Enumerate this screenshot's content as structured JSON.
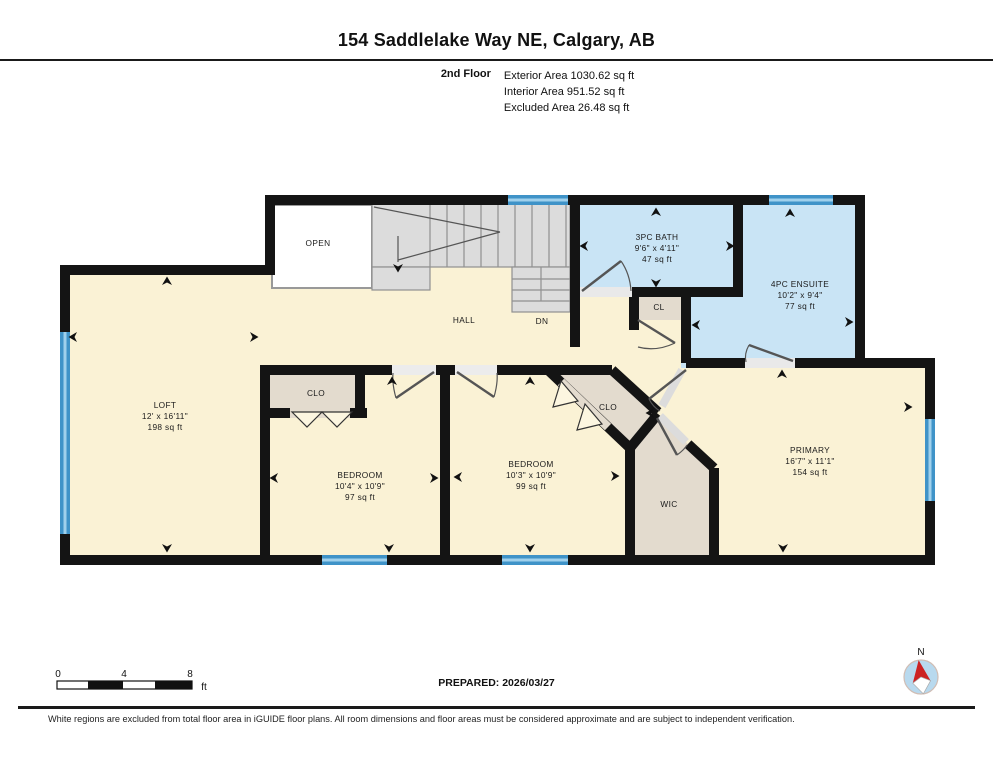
{
  "header": {
    "title": "154 Saddlelake Way NE, Calgary, AB",
    "floor_label": "2nd Floor",
    "areas": [
      "Exterior Area 1030.62 sq ft",
      "Interior Area 951.52 sq ft",
      "Excluded Area 26.48 sq ft"
    ]
  },
  "rooms": {
    "loft": {
      "name": "LOFT",
      "dims": "12' x 16'11\"",
      "area": "198 sq ft"
    },
    "bedroom_left": {
      "name": "BEDROOM",
      "dims": "10'4\" x 10'9\"",
      "area": "97 sq ft"
    },
    "bedroom_middle": {
      "name": "BEDROOM",
      "dims": "10'3\" x 10'9\"",
      "area": "99 sq ft"
    },
    "primary": {
      "name": "PRIMARY",
      "dims": "16'7\" x 11'1\"",
      "area": "154 sq ft"
    },
    "bath": {
      "name": "3PC BATH",
      "dims": "9'6\" x 4'11\"",
      "area": "47 sq ft"
    },
    "ensuite": {
      "name": "4PC ENSUITE",
      "dims": "10'2\" x 9'4\"",
      "area": "77 sq ft"
    }
  },
  "labels": {
    "open": "OPEN",
    "hall": "HALL",
    "dn": "DN",
    "cl": "CL",
    "clo_left": "CLO",
    "clo_middle": "CLO",
    "wic": "WIC",
    "compass_north": "N"
  },
  "footer": {
    "scale_ticks": [
      "0",
      "4",
      "8"
    ],
    "scale_unit": "ft",
    "prepared": "PREPARED: 2026/03/27",
    "disclaimer": "White regions are excluded from total floor area in iGUIDE floor plans. All room dimensions and floor areas must be considered approximate and are subject to independent verification."
  },
  "colors": {
    "room_fill": "#FAF2D5",
    "wet_room_fill": "#C9E4F5",
    "closet_fill": "#E3DBCE",
    "stairs_fill": "#DCDCDC",
    "window": "#3F93C8",
    "wall": "#141414",
    "compass_red": "#CC2222"
  }
}
